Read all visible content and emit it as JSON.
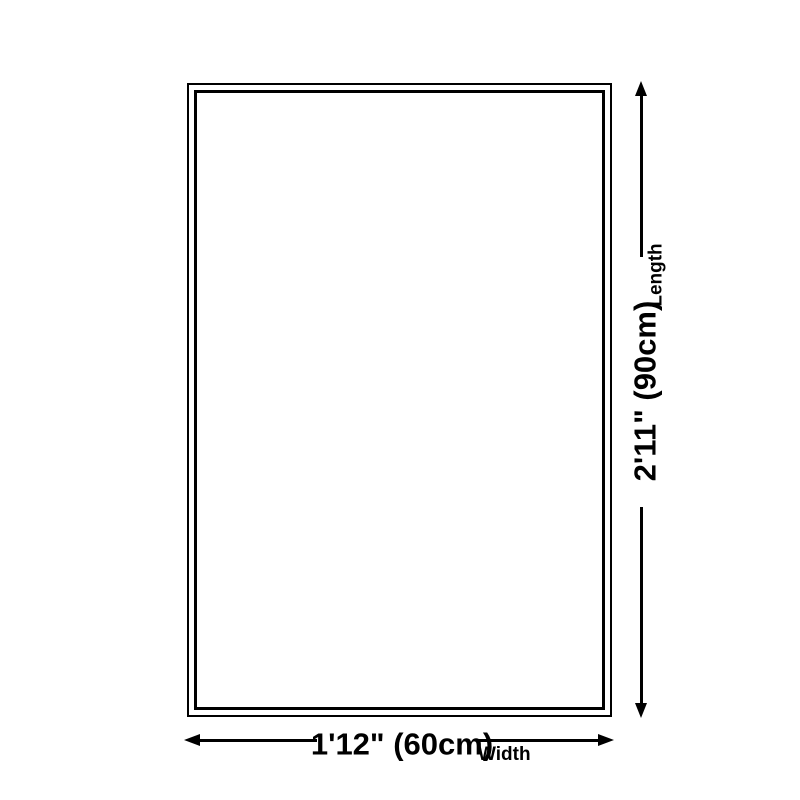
{
  "diagram": {
    "background_color": "#ffffff",
    "line_color": "#000000",
    "width": {
      "value": "1'12\" (60cm)",
      "label": "Width"
    },
    "length": {
      "value": "2'11\" (90cm)",
      "label": "Length"
    }
  }
}
